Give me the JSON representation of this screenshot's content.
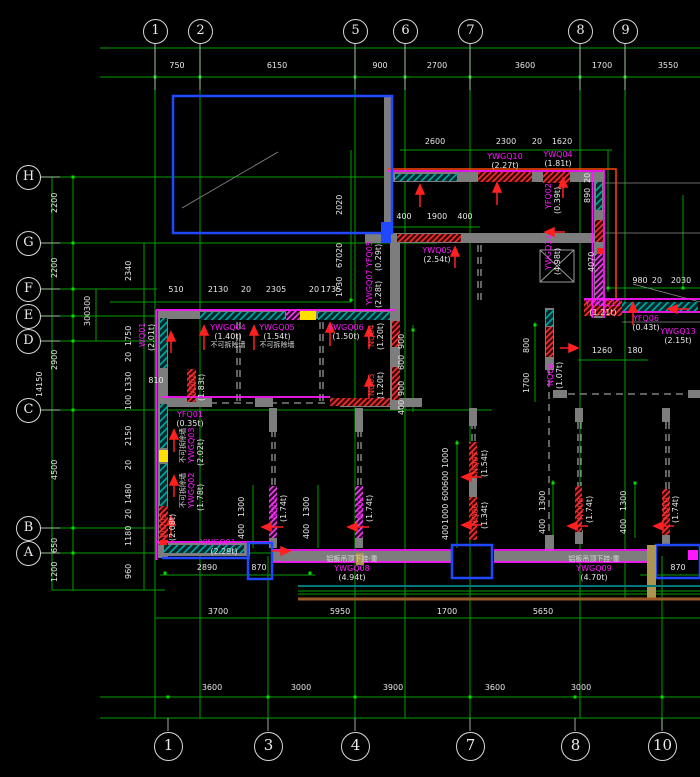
{
  "axes": {
    "top": {
      "bubbles": [
        "1",
        "2",
        "5",
        "6",
        "7",
        "8",
        "9"
      ],
      "dims": [
        "750",
        "6150",
        "900",
        "2700",
        "3600",
        "1700",
        "3550"
      ]
    },
    "bottom": {
      "bubbles": [
        "1",
        "3",
        "4",
        "7",
        "8",
        "10"
      ],
      "dims_upper": [
        "3700",
        "5950",
        "1700",
        "5650"
      ],
      "dims_lower": [
        "3600",
        "3000",
        "3900",
        "3600",
        "3000"
      ]
    },
    "left": {
      "bubbles": [
        "H",
        "G",
        "F",
        "E",
        "D",
        "C",
        "B",
        "A"
      ],
      "dims_outer": [
        "2200",
        "2200",
        "2900",
        "4500",
        "650",
        "1200"
      ],
      "total": "14150",
      "dims_inner": [
        "2340",
        "300",
        "300",
        "1750",
        "20",
        "1330",
        "100",
        "2150",
        "20",
        "1480",
        "20",
        "1180",
        "960"
      ]
    }
  },
  "dims": {
    "top_room": [
      "2600",
      "2300",
      "20",
      "1620"
    ],
    "opening": [
      "400",
      "1900",
      "400"
    ],
    "mid_row": [
      "510",
      "2130",
      "20",
      "2305",
      "20",
      "1735"
    ],
    "mid_col": [
      "2020",
      "20",
      "670",
      "1730"
    ],
    "right_col": [
      "20",
      "890",
      "4070"
    ],
    "right_row": [
      "980",
      "20",
      "2030"
    ],
    "shaft_row": [
      "1260",
      "180"
    ],
    "shaft_col": [
      "800",
      "1700"
    ],
    "left_opening": "810",
    "closet_col": [
      "900",
      "600",
      "900",
      "400"
    ],
    "bath_col": [
      "1000",
      "600",
      "600",
      "1000",
      "400"
    ],
    "door_col": [
      "1300",
      "400"
    ],
    "bottom_left": [
      "2890",
      "870"
    ],
    "bottom_right": "870"
  },
  "labels": {
    "ywgq10": {
      "id": "YWGQ10",
      "wt": "(2.27t)"
    },
    "ywq04": {
      "id": "YWQ04",
      "wt": "(1.81t)"
    },
    "yfq02": {
      "id": "YFQ02",
      "wt": "(0.39t)"
    },
    "ywq05": {
      "id": "YWQ05",
      "wt": "(2.54t)"
    },
    "ywgq11": {
      "id": "YWGQ11",
      "wt": "(4.98t)"
    },
    "ywgq12": {
      "id": "YWGQ12",
      "wt": "(1.21t)"
    },
    "yfq06": {
      "id": "YFQ06",
      "wt": "(0.43t)"
    },
    "ywgq13": {
      "id": "YWGQ13",
      "wt": "(2.15t)"
    },
    "ywgq04": {
      "id": "YWGQ04",
      "wt": "(1.40t)"
    },
    "ywgq05": {
      "id": "YWGQ05",
      "wt": "(1.54t)"
    },
    "ywgq06": {
      "id": "YWGQ06",
      "wt": "(1.50t)"
    },
    "yfq05": {
      "id": "YFQ05",
      "wt": "(0.29t)"
    },
    "ywgq07": {
      "id": "YWGQ07",
      "wt": "(2.28t)"
    },
    "wq01": {
      "id": "WQ01",
      "wt": "(2.01t)"
    },
    "wq02": {
      "id": "WQ02",
      "wt": "(1.83t)"
    },
    "yfq01": {
      "id": "YFQ01",
      "wt": "(0.35t)"
    },
    "ywgq03": {
      "id": "YWGQ03",
      "wt": "(2.02t)"
    },
    "ywgq02": {
      "id": "YWGQ02",
      "wt": "(1.78t)"
    },
    "wq03": {
      "id": "WQ03",
      "wt": "(2.08t)"
    },
    "ywgq01": {
      "id": "YWGQ01",
      "wt": "(2.29t)"
    },
    "ywgq08": {
      "id": "YWGQ08",
      "wt": "(4.94t)"
    },
    "ywgq09": {
      "id": "YWGQ09",
      "wt": "(4.70t)"
    },
    "nq01": {
      "id": "NQ01",
      "wt": "(1.74t)"
    },
    "nq02": {
      "id": "NQ02",
      "wt": "(1.74t)"
    },
    "nq03": {
      "id": "NQ03",
      "wt": "(1.20t)"
    },
    "nq04": {
      "id": "NQ04",
      "wt": "(1.20t)"
    },
    "nq06": {
      "id": "NQ06",
      "wt": "(1.34t)"
    },
    "nq07": {
      "id": "NQ07",
      "wt": "(1.54t)"
    },
    "nq08": {
      "id": "NQ08",
      "wt": "(1.74t)"
    },
    "nq09": {
      "id": "NQ09",
      "wt": "(1.07t)"
    },
    "nq10": {
      "id": "NQ10",
      "wt": "(1.74t)"
    }
  },
  "notes": {
    "non_removable": "不可拆除墙",
    "hang_note": "铝板吊顶下挂·重"
  },
  "colors": {
    "grid_green": "#00a000",
    "wall_gray": "#7d7d7d",
    "outline_blue": "#2048ff",
    "edge_magenta": "#ff18ff",
    "load_red": "#ff2020",
    "hatch_teal": "#00a8a8",
    "outline_orange": "#ff4400",
    "rail_brown": "#9c5a28"
  }
}
